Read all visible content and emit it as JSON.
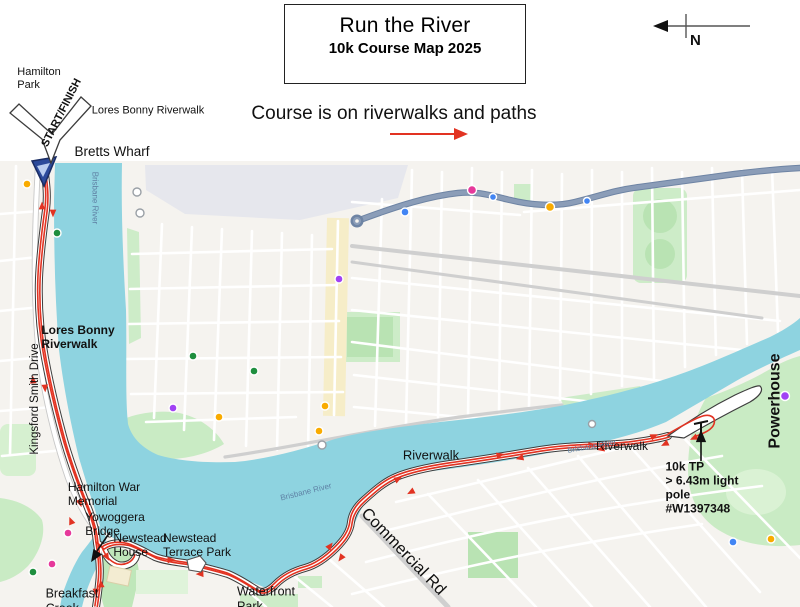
{
  "header": {
    "title": "Run the River",
    "subtitle": "10k Course Map 2025",
    "note": "Course is on riverwalks and paths",
    "north_label": "N"
  },
  "colors": {
    "course_red": "#e23322",
    "water_teal": "#8ed3e0",
    "land": "#f5f3ef",
    "park_green": "#c9ebc4",
    "park_green_dark": "#b9e3b3",
    "road_gray": "#cfcfcf",
    "highway_blue": "#8b9db8",
    "commercial_yellow": "#f6edc8",
    "label_black": "#111111",
    "water_label_blue": "#5f82a5",
    "marker_navy": "#2b4a9b",
    "callout_white": "#ffffff"
  },
  "course": {
    "name": "10k course",
    "start_finish": "START/FINISH",
    "turnaround_note": "10k TP\n> 6.43m light\npole\n#W1397348"
  },
  "map_labels": [
    {
      "id": "hamilton-park",
      "text": "Hamilton\nPark",
      "x": 39,
      "y": 79,
      "size": 11,
      "weight": 500,
      "rot": 0,
      "align": "left",
      "color": "#111"
    },
    {
      "id": "start-finish",
      "text": "START/FINISH",
      "x": 62,
      "y": 113,
      "size": 11,
      "weight": 600,
      "rot": -63,
      "align": "center",
      "color": "#111"
    },
    {
      "id": "lores-bonny-riverwalk-top",
      "text": "Lores Bonny Riverwalk",
      "x": 148,
      "y": 111,
      "size": 11,
      "weight": 500,
      "rot": 0,
      "align": "center",
      "color": "#111"
    },
    {
      "id": "bretts-wharf",
      "text": "Bretts Wharf",
      "x": 112,
      "y": 152,
      "size": 13.5,
      "weight": 500,
      "rot": 0,
      "align": "center",
      "color": "#111"
    },
    {
      "id": "lores-bonny-riverwalk-water",
      "text": "Lores Bonny\nRiverwalk",
      "x": 78,
      "y": 337,
      "size": 12,
      "weight": 600,
      "rot": 0,
      "align": "left",
      "color": "#111"
    },
    {
      "id": "kingsford-smith-drive",
      "text": "Kingsford Smith Drive",
      "x": 36,
      "y": 399,
      "size": 11.5,
      "weight": 500,
      "rot": -90,
      "align": "center",
      "color": "#111"
    },
    {
      "id": "hamilton-war-memorial",
      "text": "Hamilton War\nMemorial",
      "x": 104,
      "y": 494,
      "size": 12,
      "weight": 500,
      "rot": 0,
      "align": "left",
      "color": "#111"
    },
    {
      "id": "yowoggera-bridge",
      "text": "Yowoggera\nBridge",
      "x": 115,
      "y": 524,
      "size": 12,
      "weight": 500,
      "rot": 0,
      "align": "left",
      "color": "#111"
    },
    {
      "id": "newstead-house",
      "text": "Newstead\nHouse",
      "x": 140,
      "y": 545,
      "size": 12,
      "weight": 500,
      "rot": 0,
      "align": "left",
      "color": "#111"
    },
    {
      "id": "newstead-terrace-park",
      "text": "Newstead\nTerrace Park",
      "x": 197,
      "y": 545,
      "size": 12,
      "weight": 500,
      "rot": 0,
      "align": "left",
      "color": "#111"
    },
    {
      "id": "breakfast-creek",
      "text": "Breakfast\nCreek",
      "x": 72,
      "y": 601,
      "size": 12.5,
      "weight": 500,
      "rot": 0,
      "align": "left",
      "color": "#111"
    },
    {
      "id": "waterfront-park",
      "text": "Waterfront\nPark",
      "x": 266,
      "y": 599,
      "size": 12.5,
      "weight": 500,
      "rot": 0,
      "align": "left",
      "color": "#111"
    },
    {
      "id": "commercial-rd",
      "text": "Commercial Rd",
      "x": 403,
      "y": 552,
      "size": 16.5,
      "weight": 500,
      "rot": 46,
      "align": "center",
      "color": "#111"
    },
    {
      "id": "riverwalk-1",
      "text": "Riverwalk",
      "x": 431,
      "y": 455,
      "size": 13,
      "weight": 500,
      "rot": 0,
      "align": "center",
      "color": "#111"
    },
    {
      "id": "riverwalk-2",
      "text": "Riverwalk",
      "x": 622,
      "y": 446,
      "size": 12,
      "weight": 500,
      "rot": 0,
      "align": "center",
      "color": "#111"
    },
    {
      "id": "powerhouse",
      "text": "Powerhouse",
      "x": 776,
      "y": 401,
      "size": 16,
      "weight": 700,
      "rot": -90,
      "align": "center",
      "color": "#111"
    },
    {
      "id": "tp-note",
      "text": "10k TP\n> 6.43m light\npole\n#W1397348",
      "x": 702,
      "y": 488,
      "size": 12,
      "weight": 700,
      "rot": 0,
      "align": "left",
      "color": "#111"
    },
    {
      "id": "brisbane-river-1",
      "text": "Brisbane River",
      "x": 95,
      "y": 198,
      "size": 8,
      "weight": 400,
      "rot": 90,
      "align": "center",
      "color": "#5f82a5"
    },
    {
      "id": "brisbane-river-2",
      "text": "Brisbane River",
      "x": 306,
      "y": 492,
      "size": 8,
      "weight": 400,
      "rot": -14,
      "align": "center",
      "color": "#5f82a5"
    },
    {
      "id": "brisbane-river-3",
      "text": "Brisbane River",
      "x": 592,
      "y": 447,
      "size": 7.5,
      "weight": 400,
      "rot": -10,
      "align": "center",
      "color": "#5f82a5"
    }
  ]
}
